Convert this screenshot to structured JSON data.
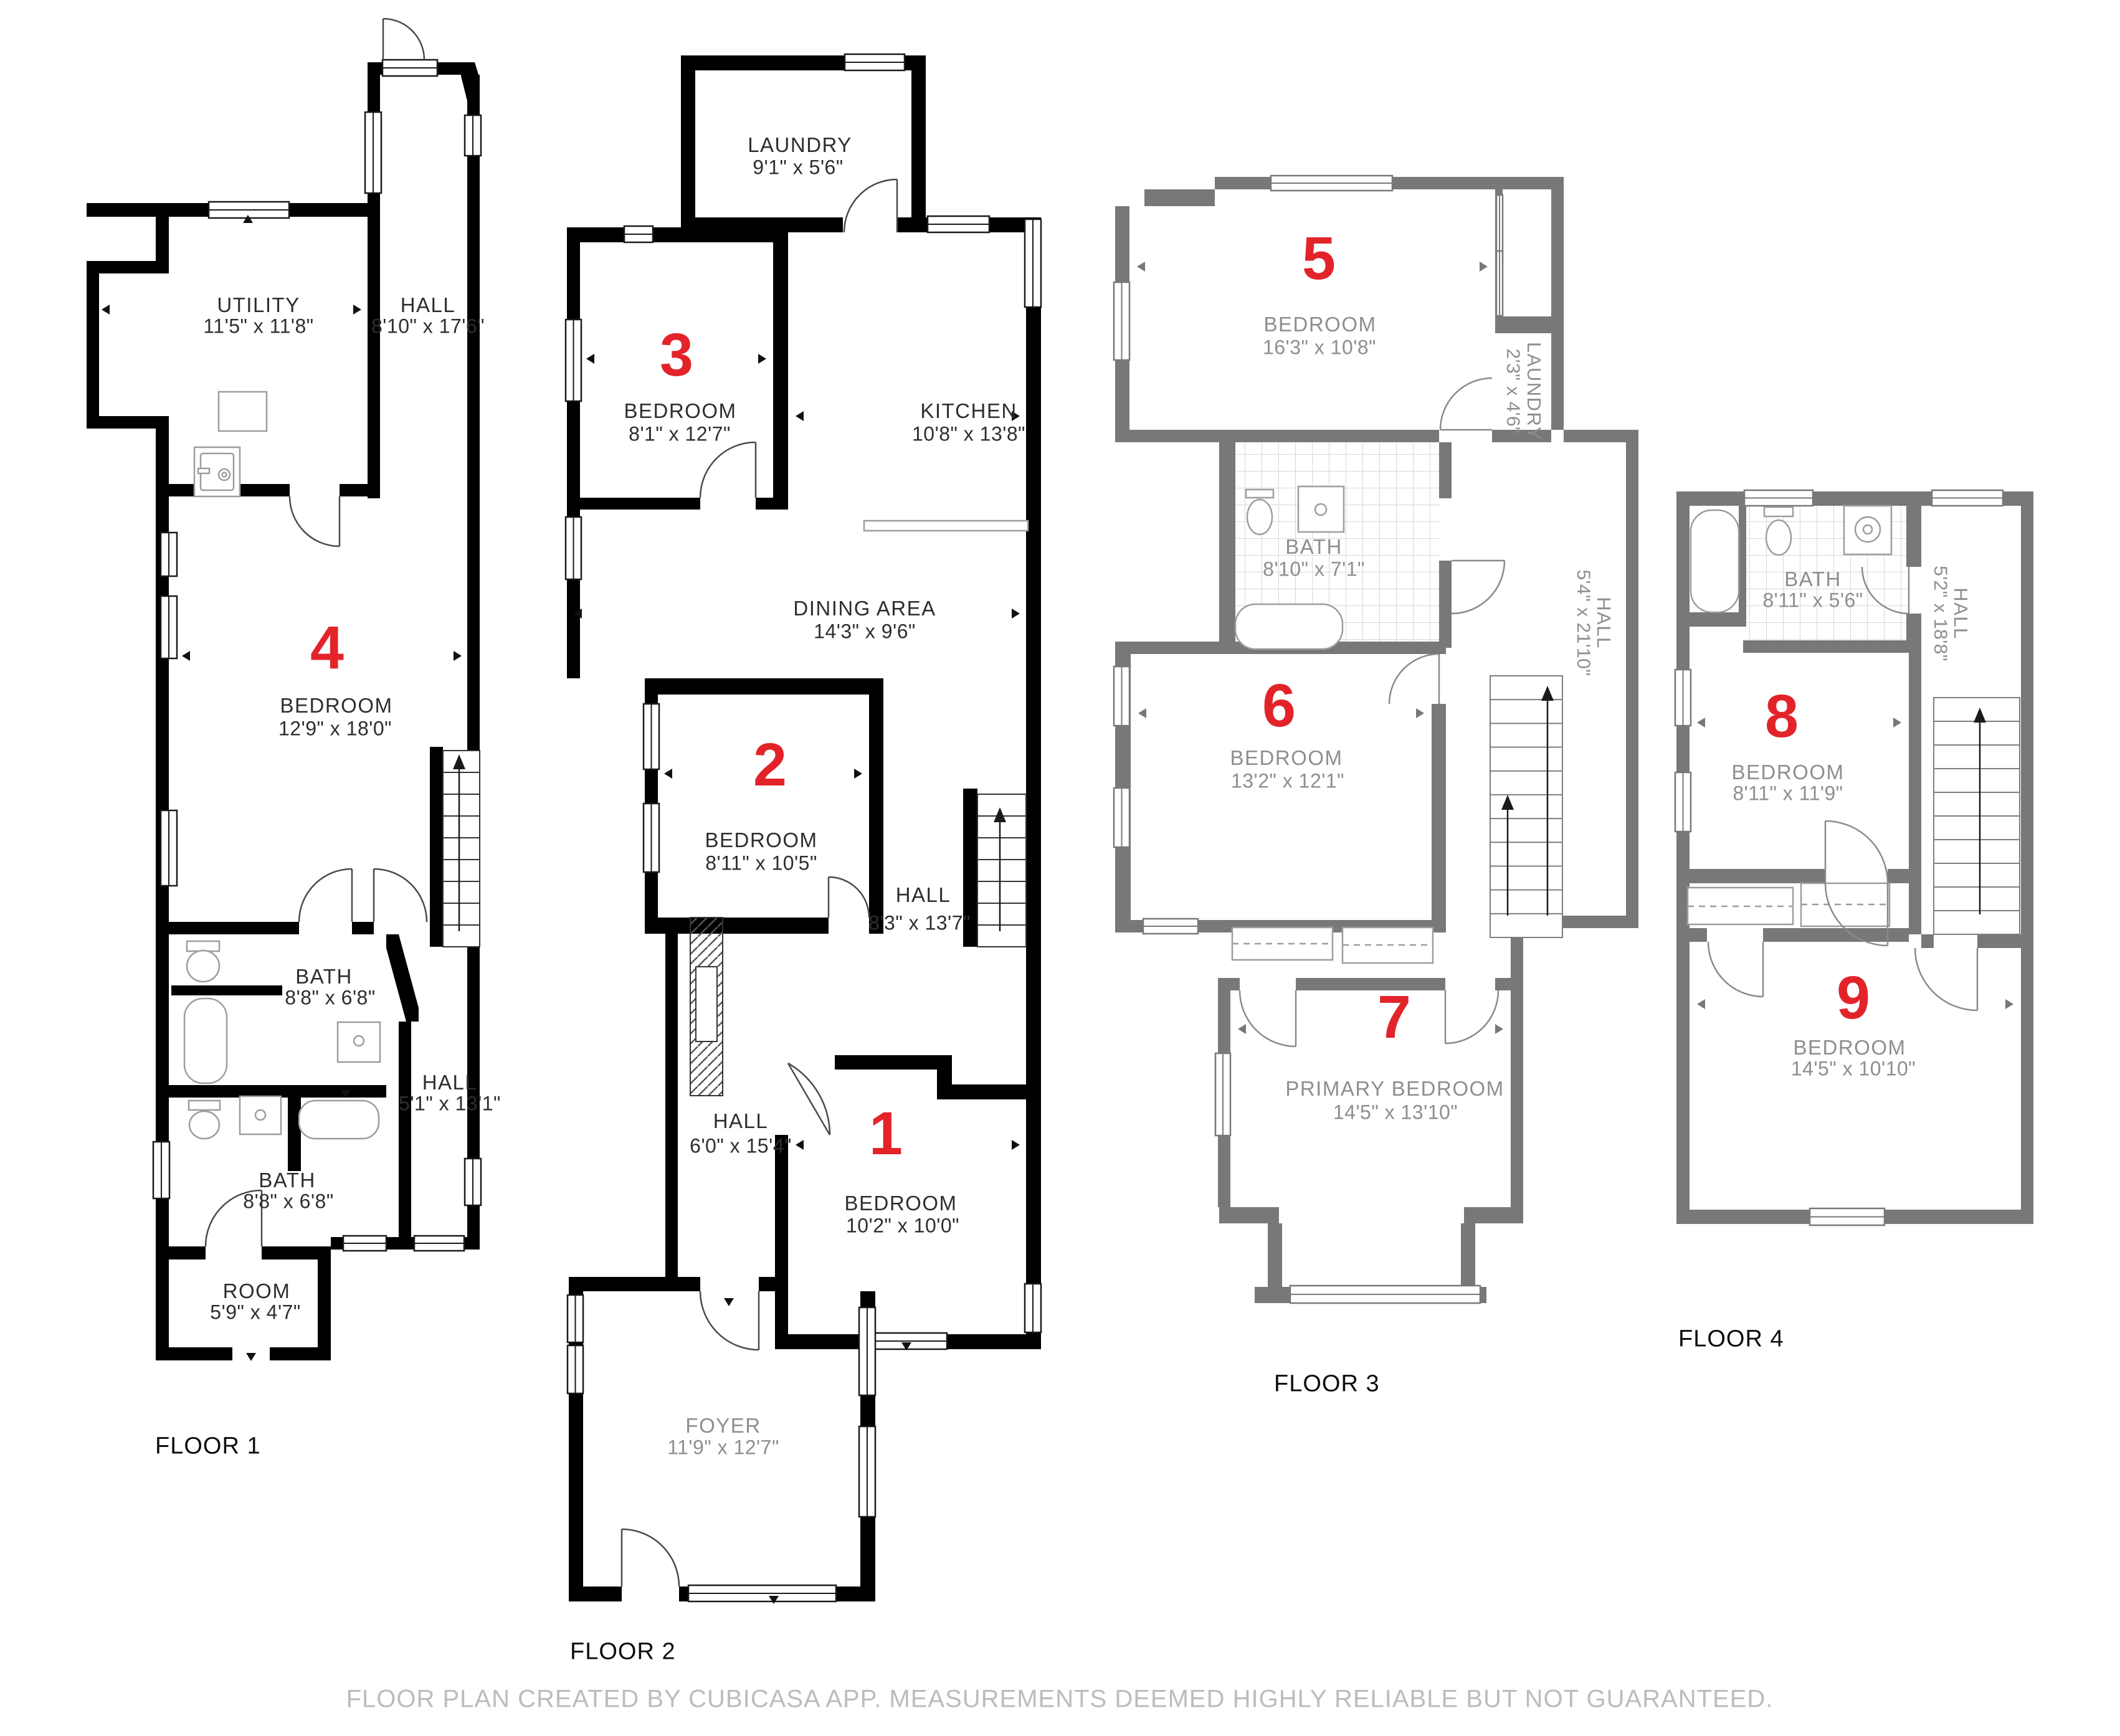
{
  "disclaimer": "FLOOR PLAN CREATED BY CUBICASA APP. MEASUREMENTS DEEMED HIGHLY RELIABLE BUT NOT GUARANTEED.",
  "colors": {
    "wall_dark": "#000000",
    "wall_gray": "#787878",
    "accent_red": "#e2242a",
    "label_dark": "#2e2e2e",
    "label_gray": "#8e8e8e",
    "disclaimer_gray": "#bcbcbc"
  },
  "floor1": {
    "caption": "FLOOR 1",
    "utility": {
      "name": "UTILITY",
      "dims": "11'5\" x 11'8\""
    },
    "hall_upper": {
      "name": "HALL",
      "dims": "8'10\" x 17'6\""
    },
    "bedroom": {
      "num": "4",
      "name": "BEDROOM",
      "dims": "12'9\" x 18'0\""
    },
    "bath_upper": {
      "name": "BATH",
      "dims": "8'8\" x 6'8\""
    },
    "hall_lower": {
      "name": "HALL",
      "dims": "5'1\" x 13'1\""
    },
    "bath_lower": {
      "name": "BATH",
      "dims": "8'8\" x 6'8\""
    },
    "room": {
      "name": "ROOM",
      "dims": "5'9\" x 4'7\""
    }
  },
  "floor2": {
    "caption": "FLOOR 2",
    "laundry": {
      "name": "LAUNDRY",
      "dims": "9'1\" x 5'6\""
    },
    "bedroom3": {
      "num": "3",
      "name": "BEDROOM",
      "dims": "8'1\" x 12'7\""
    },
    "kitchen": {
      "name": "KITCHEN",
      "dims": "10'8\" x 13'8\""
    },
    "dining": {
      "name": "DINING AREA",
      "dims": "14'3\" x 9'6\""
    },
    "bedroom2": {
      "num": "2",
      "name": "BEDROOM",
      "dims": "8'11\" x 10'5\""
    },
    "hall_right": {
      "name": "HALL",
      "dims": "8'3\" x 13'7\""
    },
    "hall_center": {
      "name": "HALL",
      "dims": "6'0\" x 15'4\""
    },
    "bedroom1": {
      "num": "1",
      "name": "BEDROOM",
      "dims": "10'2\" x 10'0\""
    },
    "foyer": {
      "name": "FOYER",
      "dims": "11'9\" x 12'7\""
    }
  },
  "floor3": {
    "caption": "FLOOR 3",
    "bedroom5": {
      "num": "5",
      "name": "BEDROOM",
      "dims": "16'3\" x 10'8\""
    },
    "laundry": {
      "name": "LAUNDRY",
      "dims": "2'3\" x 4'6\""
    },
    "bath": {
      "name": "BATH",
      "dims": "8'10\" x 7'1\""
    },
    "hall": {
      "name": "HALL",
      "dims": "5'4\" x 21'10\""
    },
    "bedroom6": {
      "num": "6",
      "name": "BEDROOM",
      "dims": "13'2\" x 12'1\""
    },
    "primary": {
      "num": "7",
      "name": "PRIMARY BEDROOM",
      "dims": "14'5\" x 13'10\""
    }
  },
  "floor4": {
    "caption": "FLOOR 4",
    "bath": {
      "name": "BATH",
      "dims": "8'11\" x 5'6\""
    },
    "hall": {
      "name": "HALL",
      "dims": "5'2\" x 18'8\""
    },
    "bedroom8": {
      "num": "8",
      "name": "BEDROOM",
      "dims": "8'11\" x 11'9\""
    },
    "bedroom9": {
      "num": "9",
      "name": "BEDROOM",
      "dims": "14'5\" x 10'10\""
    }
  }
}
